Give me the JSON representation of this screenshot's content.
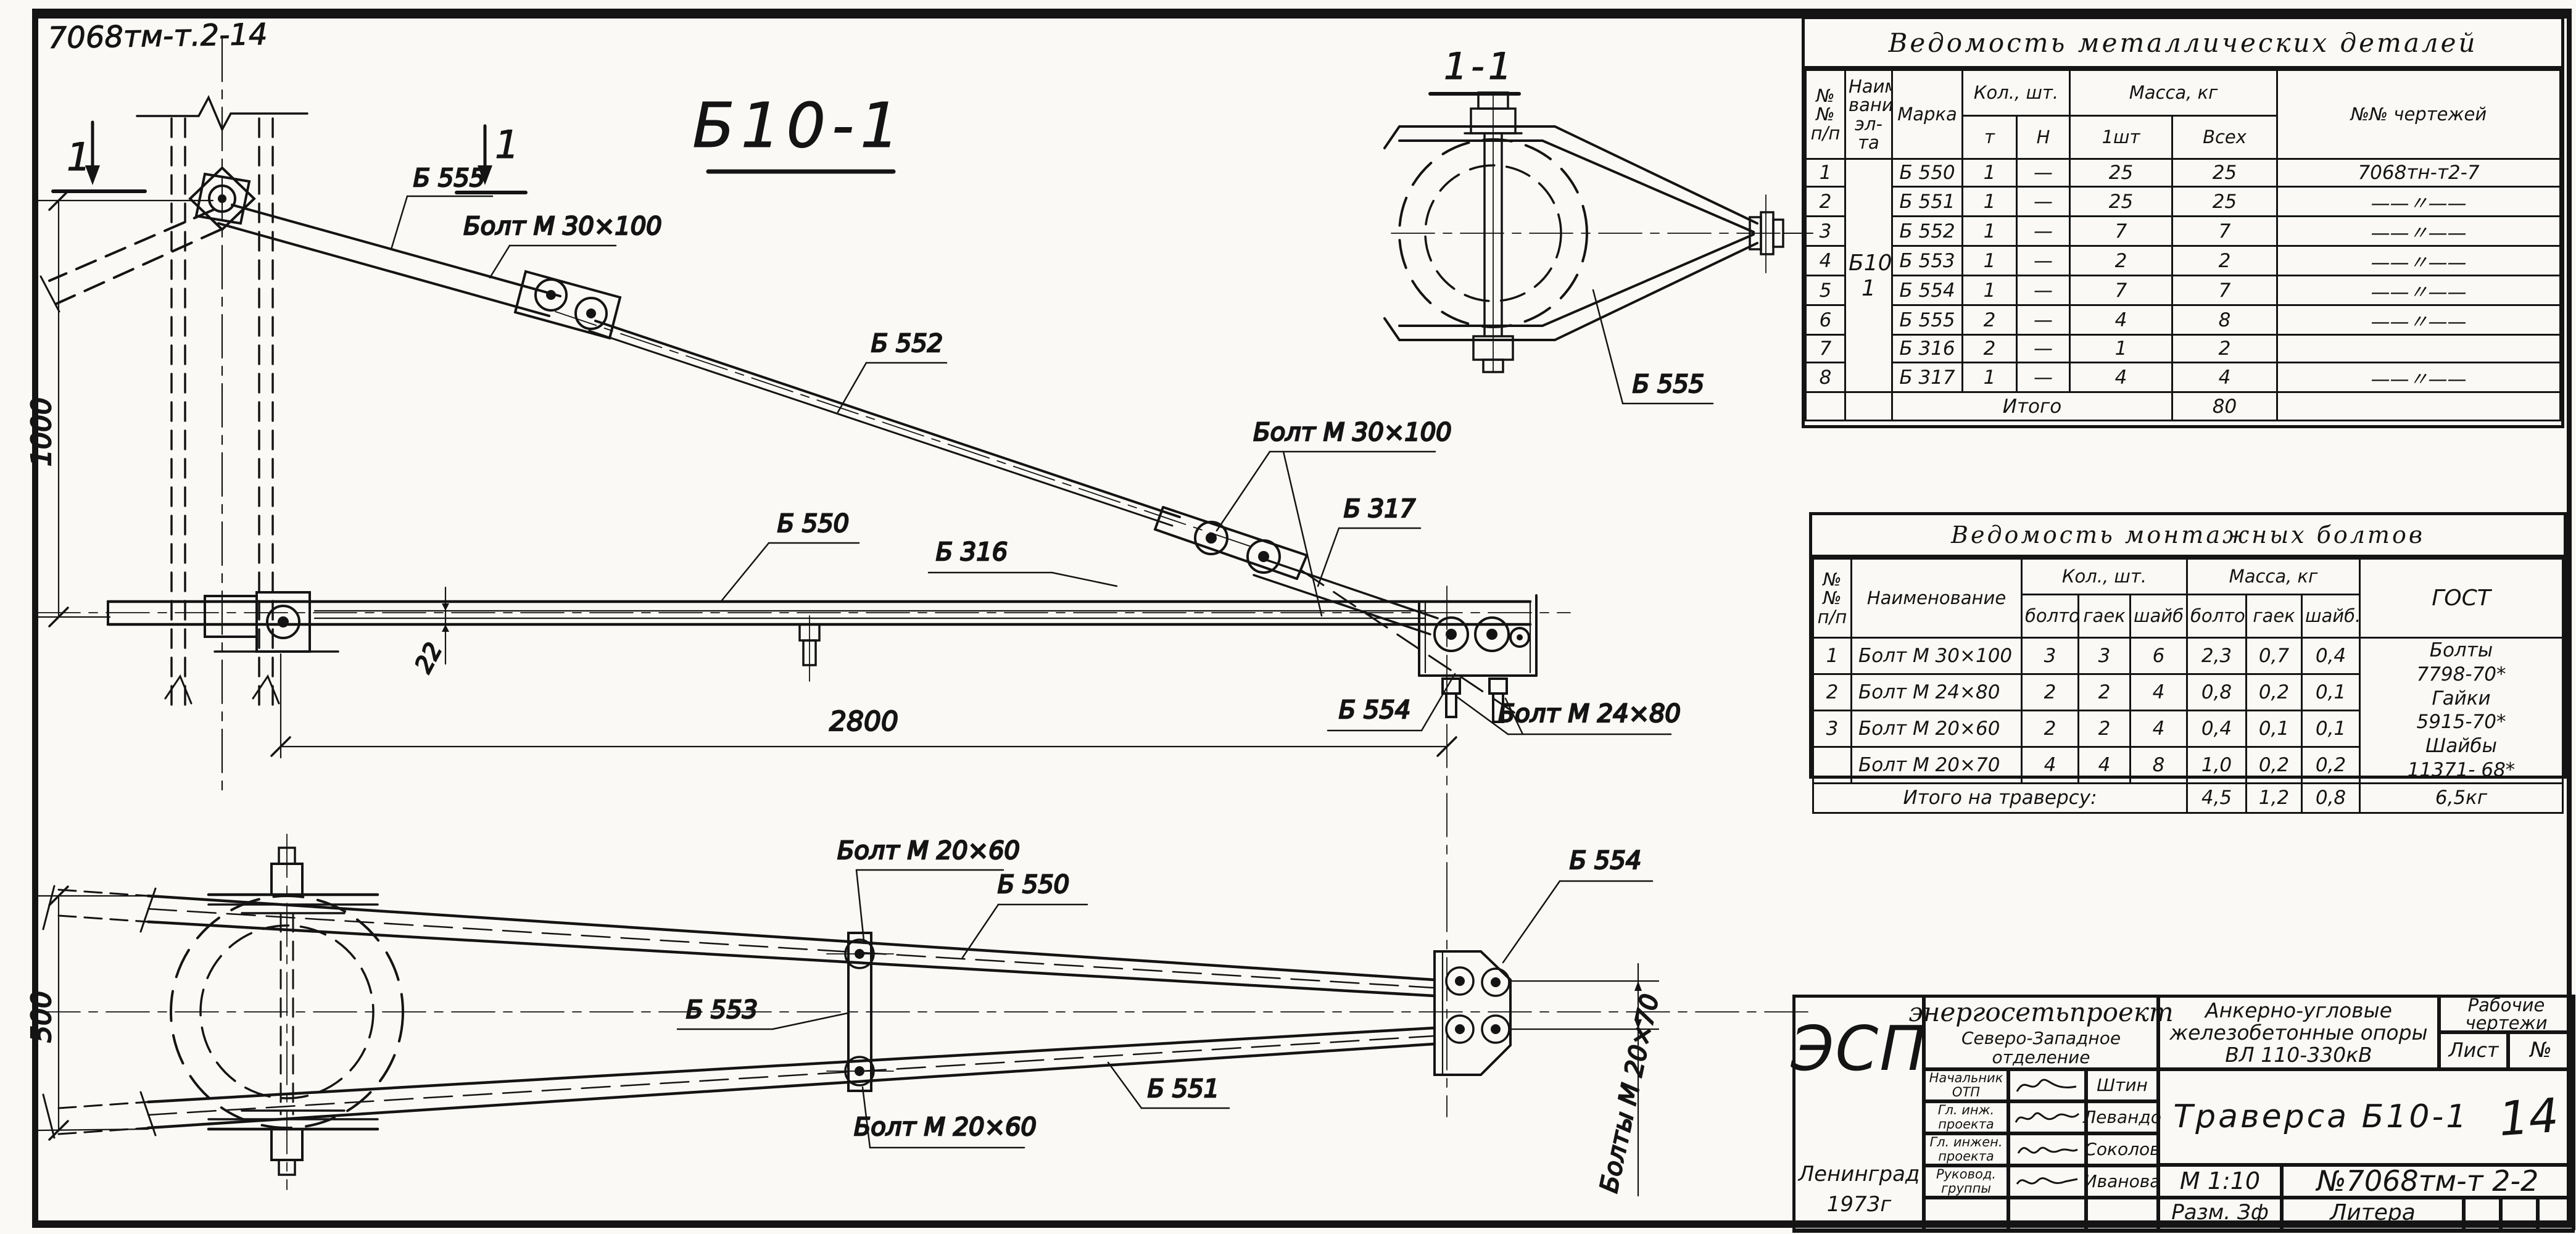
{
  "sheet": {
    "corner_code": "7068тм-т.2-14",
    "main_view_title": "Б10-1",
    "section_view_title": "1-1",
    "section_cut_mark": "1"
  },
  "drawing_labels": {
    "upper": {
      "b555": "Б 555",
      "bolt_30x100_a": "Болт М 30×100",
      "b552": "Б 552",
      "b550": "Б 550",
      "b316": "Б 316",
      "bolt_30x100_b": "Болт М 30×100",
      "b317": "Б 317",
      "b554": "Б 554",
      "bolt_24x80": "Болт М 24×80",
      "dim_1000": "1000",
      "dim_2800": "2800",
      "dim_22": "22"
    },
    "section": {
      "b555": "Б 555"
    },
    "lower": {
      "bolt_20x60_top": "Болт М 20×60",
      "b550": "Б 550",
      "b553": "Б 553",
      "b551": "Б 551",
      "bolt_20x60_bottom": "Болт М 20×60",
      "b554": "Б 554",
      "bolts_20x70": "Болты М 20×70",
      "dim_500": "500"
    }
  },
  "parts_table": {
    "title": "Ведомость металлических деталей",
    "h_num_1": "№№",
    "h_num_2": "п/п",
    "h_name_1": "Наимено-",
    "h_name_2": "вание",
    "h_name_3": "эл-та",
    "h_mark": "Марка",
    "h_qty": "Кол., шт.",
    "h_qty_m": "т",
    "h_qty_n": "Н",
    "h_mass": "Масса, кг",
    "h_mass_1": "1шт",
    "h_mass_all": "Всех",
    "h_dwg": "№№ чертежей",
    "group_mark": "Б10-1",
    "rows": [
      {
        "n": "1",
        "mark": "Б 550",
        "m": "1",
        "h": "—",
        "m1": "25",
        "all": "25",
        "dwg": "7068тн-т2-7"
      },
      {
        "n": "2",
        "mark": "Б 551",
        "m": "1",
        "h": "—",
        "m1": "25",
        "all": "25",
        "dwg": "——〃——"
      },
      {
        "n": "3",
        "mark": "Б 552",
        "m": "1",
        "h": "—",
        "m1": "7",
        "all": "7",
        "dwg": "——〃——"
      },
      {
        "n": "4",
        "mark": "Б 553",
        "m": "1",
        "h": "—",
        "m1": "2",
        "all": "2",
        "dwg": "——〃——"
      },
      {
        "n": "5",
        "mark": "Б 554",
        "m": "1",
        "h": "—",
        "m1": "7",
        "all": "7",
        "dwg": "——〃——"
      },
      {
        "n": "6",
        "mark": "Б 555",
        "m": "2",
        "h": "—",
        "m1": "4",
        "all": "8",
        "dwg": "——〃——"
      },
      {
        "n": "7",
        "mark": "Б 316",
        "m": "2",
        "h": "—",
        "m1": "1",
        "all": "2",
        "dwg": "3082тн - Т3-9"
      },
      {
        "n": "8",
        "mark": "Б 317",
        "m": "1",
        "h": "—",
        "m1": "4",
        "all": "4",
        "dwg": "——〃——"
      }
    ],
    "total_label": "Итого",
    "total": "80"
  },
  "bolts_table": {
    "title": "Ведомость монтажных болтов",
    "h_num_1": "№№",
    "h_num_2": "п/п",
    "h_name": "Наименование",
    "h_qty": "Кол., шт.",
    "h_mass": "Масса, кг",
    "h_q_bolts": "болтов",
    "h_q_nuts": "гаек",
    "h_q_wash": "шайб",
    "h_m_bolts": "болтов",
    "h_m_nuts": "гаек",
    "h_m_wash": "шайб.",
    "h_gost": "ГОСТ",
    "rows": [
      {
        "n": "1",
        "name": "Болт М 30×100",
        "qb": "3",
        "qn": "3",
        "qw": "6",
        "mb": "2,3",
        "mn": "0,7",
        "mw": "0,4"
      },
      {
        "n": "2",
        "name": "Болт М 24×80",
        "qb": "2",
        "qn": "2",
        "qw": "4",
        "mb": "0,8",
        "mn": "0,2",
        "mw": "0,1"
      },
      {
        "n": "3",
        "name": "Болт М 20×60",
        "qb": "2",
        "qn": "2",
        "qw": "4",
        "mb": "0,4",
        "mn": "0,1",
        "mw": "0,1"
      },
      {
        "n": "",
        "name": "Болт М 20×70",
        "qb": "4",
        "qn": "4",
        "qw": "8",
        "mb": "1,0",
        "mn": "0,2",
        "mw": "0,2"
      }
    ],
    "gost_1": "Болты",
    "gost_2": "7798-70*",
    "gost_3": "Гайки",
    "gost_4": "5915-70*",
    "gost_5": "Шайбы",
    "gost_6": "11371- 68*",
    "total_label": "Итого на траверсу:",
    "t_mb": "4,5",
    "t_mn": "1,2",
    "t_mw": "0,8",
    "t_total": "6,5кг"
  },
  "title_block": {
    "logo": "ЭСП",
    "org": "энергосетьпроект",
    "branch": "Северо-Западное отделение",
    "project_1": "Анкерно-угловые",
    "project_2": "железобетонные опоры",
    "project_3": "ВЛ 110-330кВ",
    "doc_kind_1": "Рабочие",
    "doc_kind_2": "чертежи",
    "sheet_label": "Лист",
    "sheet_no": "№",
    "signers": [
      {
        "role_1": "Начальник",
        "role_2": "ОТП",
        "name": "Штин"
      },
      {
        "role_1": "Гл. инж.",
        "role_2": "проекта",
        "name": "Левандо"
      },
      {
        "role_1": "Гл. инжен.",
        "role_2": "проекта",
        "name": "Соколов"
      },
      {
        "role_1": "Руковод.",
        "role_2": "группы",
        "name": "Иванова"
      }
    ],
    "title": "Траверса Б10-1",
    "page_note": "14",
    "scale": "М 1:10",
    "doc_no": "№7068тм-т 2-2",
    "size": "Разм. Зф",
    "litera": "Литера",
    "city": "Ленинград",
    "year": "1973г"
  }
}
